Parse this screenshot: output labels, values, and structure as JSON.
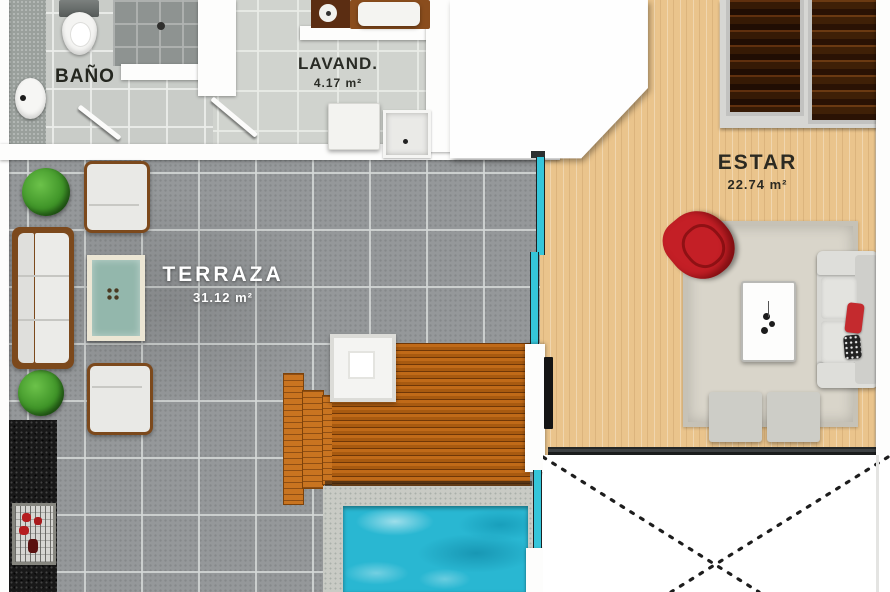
{
  "plan": {
    "title": "apartment floor plan",
    "rooms": {
      "bano": {
        "name": "BAÑO"
      },
      "lavanderia": {
        "name": "LAVAND.",
        "area": "4.17 m²"
      },
      "terraza": {
        "name": "TERRAZA",
        "area": "31.12 m²"
      },
      "estar": {
        "name": "ESTAR",
        "area": "22.74 m²"
      }
    },
    "colors": {
      "wall": "#fdfdfc",
      "terrace_tile": "#95989a",
      "bath_tile": "#c9ccc8",
      "laundry_tile": "#d0d3ce",
      "wood_floor": "#eac48c",
      "deck_wood": "#b4620f",
      "pool_water": "#29b7d2",
      "glass": "#35c6da",
      "accent_red": "#c41f26",
      "granite": "#181818",
      "label_dark": "#2a2a26",
      "label_light": "#ffffff"
    }
  }
}
